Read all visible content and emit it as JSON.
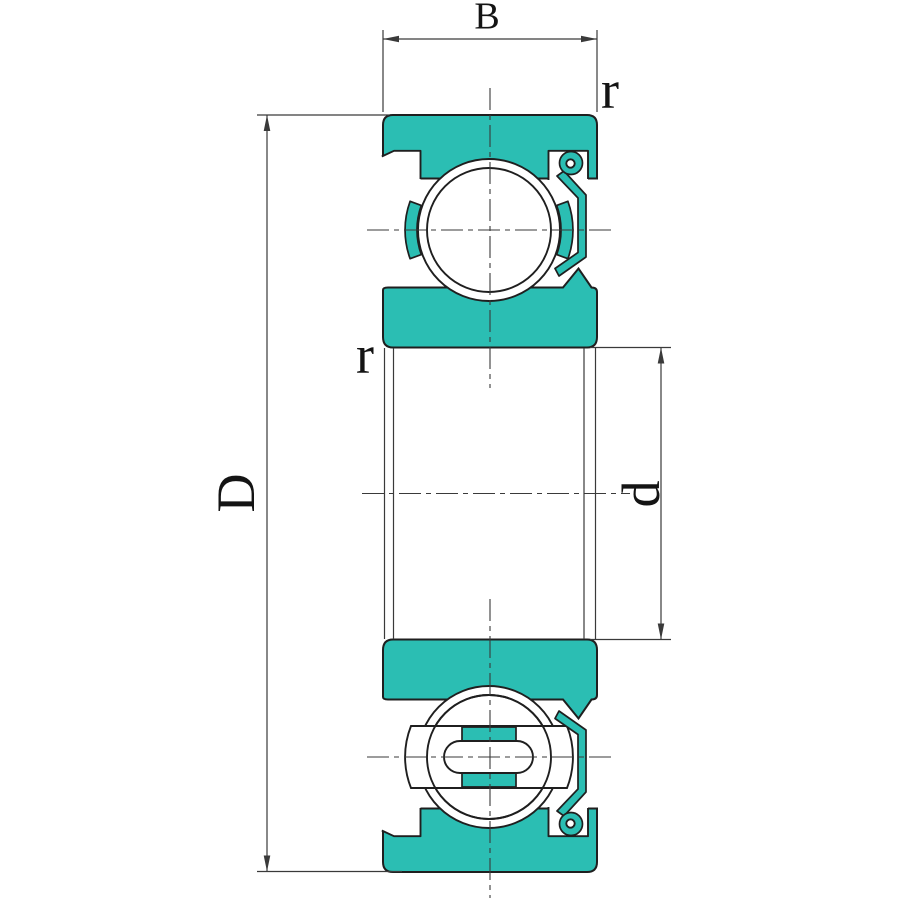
{
  "drawing": {
    "kind": "deep-groove-ball-bearing-cross-section",
    "labels": {
      "width": "B",
      "outer_diameter": "D",
      "bore_diameter": "d",
      "outer_corner_radius": "r",
      "inner_corner_radius": "r"
    }
  },
  "colors": {
    "ring_fill": "#2BBEB3",
    "outline": "#1f1f1f",
    "line": "#3a3a3a",
    "background": "#ffffff"
  }
}
